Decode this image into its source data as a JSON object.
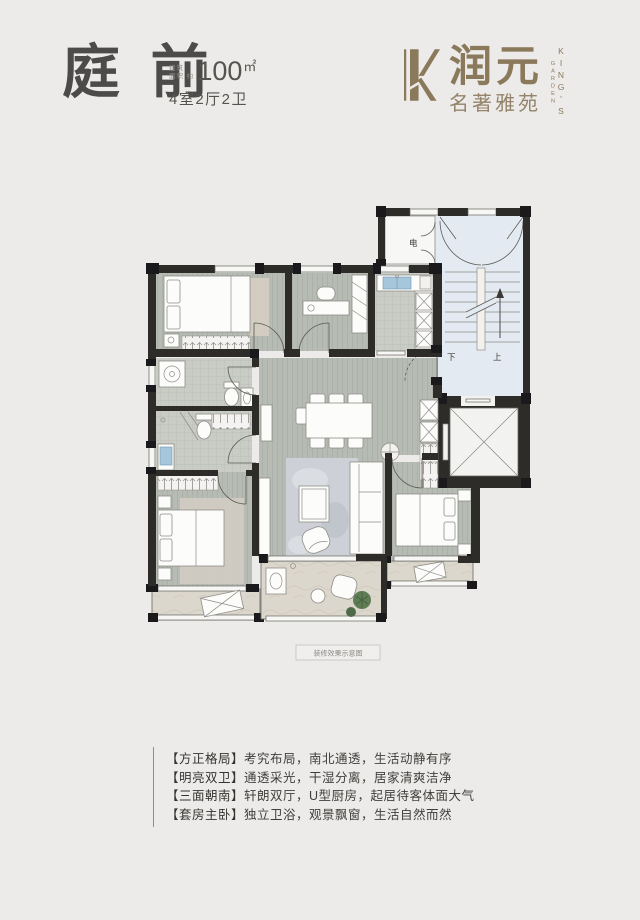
{
  "header": {
    "title": "庭 前",
    "area_prefix1": "建筑",
    "area_prefix2": "面积 约",
    "area_value": "100",
    "area_unit": "㎡",
    "rooms": "4室2厅2卫"
  },
  "logo": {
    "cn": "润元",
    "sub": "名著雅苑",
    "en_main": "KING'S",
    "en_sub": "GARDEN",
    "brand_color": "#8a795a"
  },
  "plan": {
    "label_meter": "电",
    "label_down": "下",
    "label_up": "上",
    "caption": "装修效果示意图"
  },
  "features": [
    {
      "label": "【方正格局】",
      "text": "考究布局，南北通透，生活动静有序"
    },
    {
      "label": "【明亮双卫】",
      "text": "通透采光，干湿分离，居家清爽洁净"
    },
    {
      "label": "【三面朝南】",
      "text": "轩朗双厅，U型厨房，起居待客体面大气"
    },
    {
      "label": "【套房主卧】",
      "text": "独立卫浴，观景飘窗，生活自然而然"
    }
  ]
}
